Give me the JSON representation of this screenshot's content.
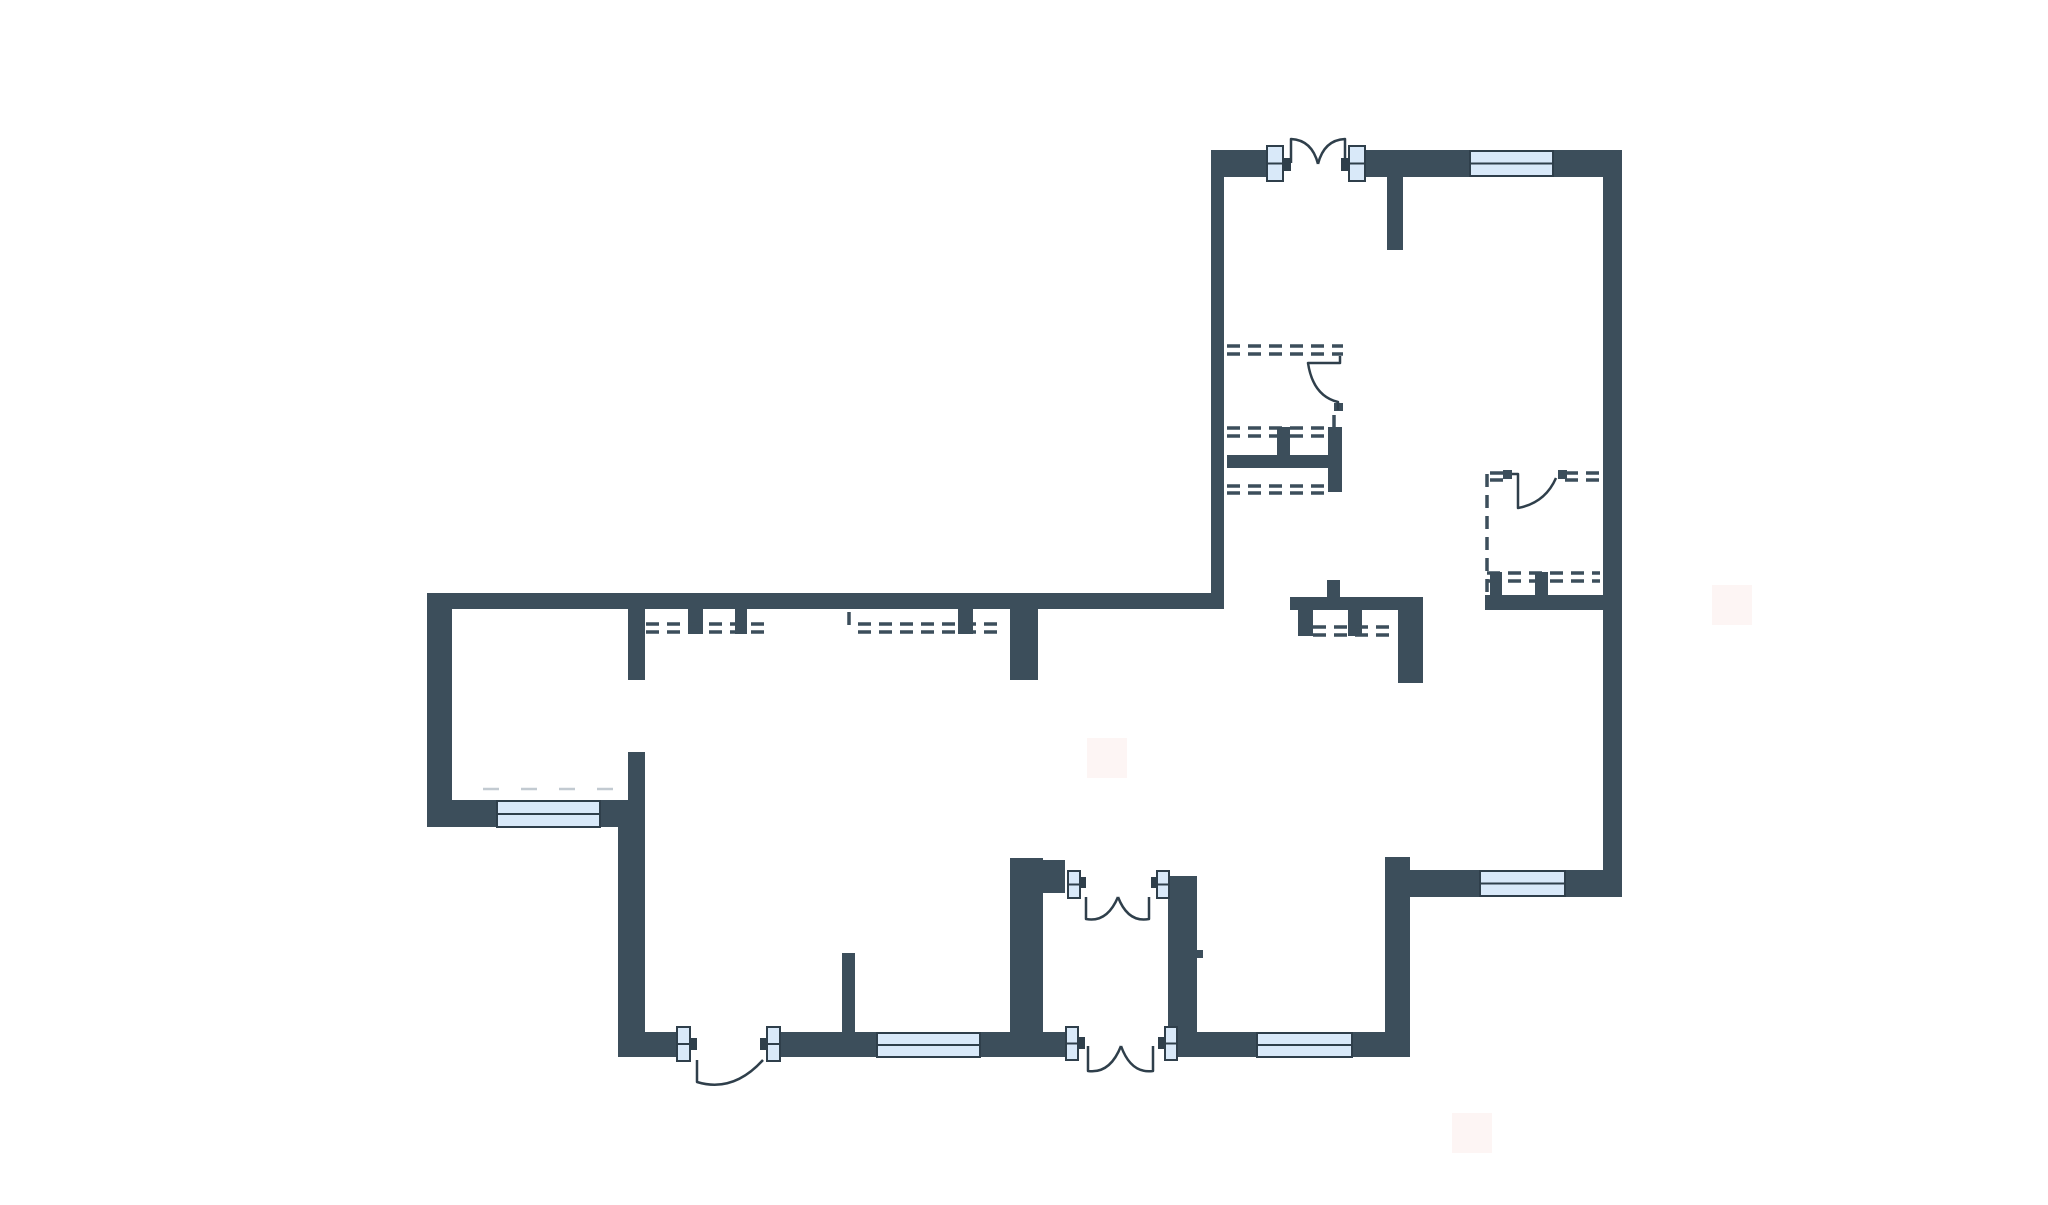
{
  "meta": {
    "description": "apartment-floor-plan",
    "canvas": {
      "width": 2048,
      "height": 1205
    }
  },
  "palette": {
    "background": "#ffffff",
    "wall": "#3c4e5b",
    "line": "#2f3f4b",
    "window_fill": "#d9e9f9",
    "frame_fill": "#d9e9f9",
    "faint_pink": "#fbeeec",
    "faint_gray": "#b3bec6"
  },
  "floorplan": {
    "walls": [
      {
        "name": "north-wall-left-section",
        "x": 427,
        "y": 593,
        "w": 797,
        "h": 16
      },
      {
        "name": "west-outer-wall",
        "x": 427,
        "y": 593,
        "w": 25,
        "h": 234
      },
      {
        "name": "southwest-room-bottom-wall",
        "x": 427,
        "y": 800,
        "w": 218,
        "h": 27
      },
      {
        "name": "left-room-divider-upper",
        "x": 628,
        "y": 609,
        "w": 17,
        "h": 71
      },
      {
        "name": "left-room-divider-lower",
        "x": 628,
        "y": 752,
        "w": 17,
        "h": 60
      },
      {
        "name": "bottom-left-outer-wall",
        "x": 618,
        "y": 800,
        "w": 27,
        "h": 257
      },
      {
        "name": "south-wall-segment-a",
        "x": 618,
        "y": 1032,
        "w": 59,
        "h": 25
      },
      {
        "name": "south-wall-segment-b",
        "x": 780,
        "y": 1032,
        "w": 285,
        "h": 25
      },
      {
        "name": "south-wall-segment-c",
        "x": 1177,
        "y": 1032,
        "w": 233,
        "h": 25
      },
      {
        "name": "hall-partition-stub-a",
        "x": 688,
        "y": 609,
        "w": 15,
        "h": 25
      },
      {
        "name": "hall-partition-stub-b",
        "x": 735,
        "y": 609,
        "w": 12,
        "h": 25
      },
      {
        "name": "hall-partition-stub-c",
        "x": 958,
        "y": 609,
        "w": 15,
        "h": 25
      },
      {
        "name": "hall-center-pier",
        "x": 1010,
        "y": 609,
        "w": 28,
        "h": 71
      },
      {
        "name": "bottomleft-room-east-wall",
        "x": 1010,
        "y": 858,
        "w": 33,
        "h": 174
      },
      {
        "name": "vestibule-arm",
        "x": 1043,
        "y": 860,
        "w": 22,
        "h": 33
      },
      {
        "name": "vestibule-east-wall",
        "x": 1168,
        "y": 876,
        "w": 29,
        "h": 159
      },
      {
        "name": "vestibule-wall-notch",
        "x": 1197,
        "y": 950,
        "w": 6,
        "h": 8
      },
      {
        "name": "middle-room-east-wall",
        "x": 1385,
        "y": 857,
        "w": 25,
        "h": 200
      },
      {
        "name": "southeast-room-bottom-wall",
        "x": 1410,
        "y": 870,
        "w": 212,
        "h": 27
      },
      {
        "name": "east-outer-wall",
        "x": 1603,
        "y": 150,
        "w": 19,
        "h": 747
      },
      {
        "name": "north-wall-entry-left",
        "x": 1211,
        "y": 150,
        "w": 56,
        "h": 27
      },
      {
        "name": "north-wall-entry-right",
        "x": 1365,
        "y": 150,
        "w": 257,
        "h": 27
      },
      {
        "name": "upper-block-west-wall",
        "x": 1211,
        "y": 150,
        "w": 13,
        "h": 459
      },
      {
        "name": "entry-stub-wall",
        "x": 1387,
        "y": 177,
        "w": 16,
        "h": 73
      },
      {
        "name": "wc-bottom-wall",
        "x": 1227,
        "y": 455,
        "w": 108,
        "h": 13
      },
      {
        "name": "wc-stub",
        "x": 1277,
        "y": 427,
        "w": 13,
        "h": 28
      },
      {
        "name": "wc-east-wall",
        "x": 1328,
        "y": 427,
        "w": 14,
        "h": 65
      },
      {
        "name": "island-horizontal-wall",
        "x": 1290,
        "y": 597,
        "w": 108,
        "h": 13
      },
      {
        "name": "island-up-stub",
        "x": 1327,
        "y": 580,
        "w": 13,
        "h": 17
      },
      {
        "name": "island-down-stub-a",
        "x": 1298,
        "y": 610,
        "w": 15,
        "h": 26
      },
      {
        "name": "island-down-stub-b",
        "x": 1348,
        "y": 610,
        "w": 14,
        "h": 26
      },
      {
        "name": "island-corner-block",
        "x": 1398,
        "y": 597,
        "w": 25,
        "h": 86
      },
      {
        "name": "bath-bottom-wall",
        "x": 1485,
        "y": 595,
        "w": 118,
        "h": 15
      },
      {
        "name": "bath-stub-a",
        "x": 1490,
        "y": 572,
        "w": 12,
        "h": 23
      },
      {
        "name": "bath-stub-b",
        "x": 1535,
        "y": 572,
        "w": 13,
        "h": 23
      },
      {
        "name": "bottomleft-room-small-stub",
        "x": 842,
        "y": 953,
        "w": 13,
        "h": 79
      },
      {
        "name": "bath-door-hinge-block-a",
        "x": 1503,
        "y": 470,
        "w": 9,
        "h": 9
      },
      {
        "name": "bath-door-hinge-block-b",
        "x": 1558,
        "y": 470,
        "w": 9,
        "h": 9
      },
      {
        "name": "wc-door-arc-stub",
        "x": 1334,
        "y": 403,
        "w": 9,
        "h": 8
      }
    ],
    "windows": [
      {
        "name": "window-southwest-room",
        "x": 497,
        "y": 801,
        "w": 103,
        "h": 26
      },
      {
        "name": "window-bottomleft-room",
        "x": 877,
        "y": 1033,
        "w": 103,
        "h": 24
      },
      {
        "name": "window-bottom-middle-room",
        "x": 1257,
        "y": 1033,
        "w": 95,
        "h": 24
      },
      {
        "name": "window-southeast-room",
        "x": 1480,
        "y": 871,
        "w": 85,
        "h": 25
      },
      {
        "name": "window-top-room",
        "x": 1470,
        "y": 151,
        "w": 83,
        "h": 25
      }
    ],
    "door_frames": [
      {
        "name": "entry-door-frame-left",
        "x": 1267,
        "y": 146,
        "w": 16,
        "h": 35
      },
      {
        "name": "entry-door-frame-right",
        "x": 1349,
        "y": 146,
        "w": 16,
        "h": 35
      },
      {
        "name": "bottomleft-door-frame-left",
        "x": 677,
        "y": 1027,
        "w": 13,
        "h": 34
      },
      {
        "name": "bottomleft-door-frame-right",
        "x": 767,
        "y": 1027,
        "w": 13,
        "h": 34
      },
      {
        "name": "vestibule-top-door-frame-left",
        "x": 1068,
        "y": 871,
        "w": 12,
        "h": 27
      },
      {
        "name": "vestibule-top-door-frame-right",
        "x": 1157,
        "y": 871,
        "w": 12,
        "h": 27
      },
      {
        "name": "vestibule-bottom-door-frame-left",
        "x": 1066,
        "y": 1027,
        "w": 12,
        "h": 33
      },
      {
        "name": "vestibule-bottom-door-frame-right",
        "x": 1165,
        "y": 1027,
        "w": 12,
        "h": 33
      }
    ],
    "door_nubs": [
      {
        "x": 1283,
        "y": 158,
        "w": 8,
        "h": 13
      },
      {
        "x": 1341,
        "y": 158,
        "w": 8,
        "h": 13
      },
      {
        "x": 690,
        "y": 1038,
        "w": 7,
        "h": 12
      },
      {
        "x": 760,
        "y": 1038,
        "w": 7,
        "h": 12
      },
      {
        "x": 1080,
        "y": 877,
        "w": 6,
        "h": 11
      },
      {
        "x": 1151,
        "y": 877,
        "w": 6,
        "h": 11
      },
      {
        "x": 1078,
        "y": 1037,
        "w": 7,
        "h": 12
      },
      {
        "x": 1158,
        "y": 1037,
        "w": 7,
        "h": 12
      }
    ],
    "door_swings": [
      {
        "name": "entry-door-swing-left",
        "path": "M1291,163 L1291,139 Q1312,140 1318,164"
      },
      {
        "name": "entry-door-swing-right",
        "path": "M1345,163 L1345,139 Q1324,140 1318,164"
      },
      {
        "name": "bottomleft-door-swing",
        "path": "M697,1060 L697,1082 Q733,1093 763,1060"
      },
      {
        "name": "vestibule-top-door-swing-left",
        "path": "M1086,897 L1086,919 Q1107,923 1118,897"
      },
      {
        "name": "vestibule-top-door-swing-right",
        "path": "M1149,897 L1149,919 Q1128,923 1118,897"
      },
      {
        "name": "vestibule-bottom-door-swing-left",
        "path": "M1088,1046 L1088,1071 Q1110,1074 1121,1046"
      },
      {
        "name": "vestibule-bottom-door-swing-right",
        "path": "M1153,1046 L1153,1071 Q1131,1074 1121,1046"
      },
      {
        "name": "wc-door-swing",
        "path": "M1340,356 L1340,363 L1308,363 Q1313,396 1338,402 L1338,410"
      },
      {
        "name": "bath-door-swing",
        "path": "M1512,474 L1518,474 L1518,508 Q1545,503 1556,478"
      }
    ],
    "dashed_double": [
      {
        "name": "hall-partition-dash-left",
        "x1": 646,
        "x2": 768,
        "y1": 624,
        "y2": 632
      },
      {
        "name": "hall-partition-dash-right",
        "x1": 858,
        "x2": 1000,
        "y1": 624,
        "y2": 632
      },
      {
        "name": "island-partition-dash",
        "x1": 1313,
        "x2": 1397,
        "y1": 627,
        "y2": 635
      },
      {
        "name": "wc-top-partition-dash",
        "x1": 1227,
        "x2": 1343,
        "y1": 346,
        "y2": 354
      },
      {
        "name": "wc-mid-partition-dash",
        "x1": 1227,
        "x2": 1328,
        "y1": 428,
        "y2": 436
      },
      {
        "name": "wc-low-partition-dash",
        "x1": 1227,
        "x2": 1330,
        "y1": 486,
        "y2": 493
      },
      {
        "name": "bath-mid-partition-dash",
        "x1": 1487,
        "x2": 1600,
        "y1": 573,
        "y2": 581
      },
      {
        "name": "bath-top-partition-dash-a",
        "x1": 1490,
        "x2": 1505,
        "y1": 473,
        "y2": 480
      },
      {
        "name": "bath-top-partition-dash-b",
        "x1": 1565,
        "x2": 1602,
        "y1": 473,
        "y2": 480
      }
    ],
    "dashed_vertical": [
      {
        "name": "bath-west-partition-dash",
        "x": 1487,
        "y1": 474,
        "y2": 608
      },
      {
        "name": "hall-partition-dash-bracket",
        "x": 849,
        "y1": 612,
        "y2": 633
      },
      {
        "name": "wc-east-wall-tick",
        "x": 1334,
        "y1": 415,
        "y2": 427
      }
    ],
    "faint_squares": [
      {
        "x": 1087,
        "y": 738,
        "w": 40,
        "h": 40
      },
      {
        "x": 1452,
        "y": 1113,
        "w": 40,
        "h": 40
      },
      {
        "x": 1712,
        "y": 585,
        "w": 40,
        "h": 40
      }
    ],
    "faint_dashes": [
      {
        "name": "radiator-hint-line",
        "x1": 483,
        "x2": 627,
        "y": 789
      }
    ]
  }
}
